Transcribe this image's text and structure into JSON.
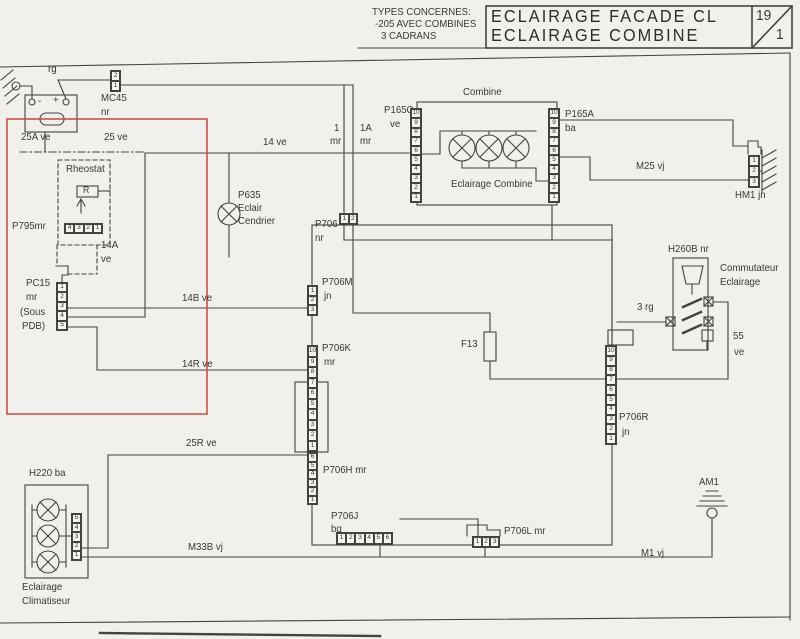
{
  "header": {
    "types_line1": "TYPES CONCERNES:",
    "types_line2": "-205 AVEC COMBINES",
    "types_line3": "3 CADRANS",
    "title_line1": "ECLAIRAGE FACADE CL",
    "title_line2": "ECLAIRAGE COMBINE",
    "page_num": "19",
    "page_den": "1"
  },
  "colors": {
    "red_zone": "#c2493f",
    "line": "#45433e"
  },
  "battery": {
    "minus": "-",
    "plus": "+"
  },
  "wire_labels": {
    "rg": "rg",
    "ve25a": "25A ve",
    "ve25": "25 ve",
    "ve14": "14 ve",
    "one": "1",
    "one_mr": "mr",
    "onea": "1A",
    "onea_mr": "mr",
    "ve14a_1": "14A",
    "ve14a_2": "ve",
    "ve14b": "14B ve",
    "ve14r": "14R ve",
    "ve25r": "25R ve",
    "m33b": "M33B vj",
    "m25": "M25 vj",
    "m1": "M1 vj",
    "rg3": "3 rg",
    "v55_1": "55",
    "v55_2": "ve",
    "f13": "F13",
    "am1": "AM1"
  },
  "components": {
    "rheostat": {
      "label": "Rheostat",
      "symbol": "R"
    },
    "p635": {
      "name": "P635",
      "line2": "Eclair",
      "line3": "Cendrier"
    },
    "combine": {
      "title": "Combine",
      "caption": "Eclairage Combine"
    },
    "h260b": {
      "name": "H260B nr",
      "desc1": "Commutateur",
      "desc2": "Eclairage"
    },
    "h220": {
      "name": "H220 ba",
      "desc1": "Eclairage",
      "desc2": "Climatiseur"
    }
  },
  "connectors": {
    "mc45": {
      "name": "MC45",
      "sub": "nr",
      "pins": [
        "2",
        "1"
      ]
    },
    "p795": {
      "name": "P795mr",
      "pins": [
        "4",
        "3",
        "2",
        "1"
      ]
    },
    "pc15": {
      "name": "PC15",
      "sub": "mr",
      "sub2": "(Sous",
      "sub3": "PDB)",
      "pins": [
        "1",
        "2",
        "3",
        "4",
        "5"
      ]
    },
    "p706": {
      "name": "P706",
      "sub": "nr",
      "pins": [
        "1",
        "2"
      ]
    },
    "p706m": {
      "name": "P706M",
      "sub": "jn",
      "pins": [
        "1",
        "2",
        "3"
      ]
    },
    "p706k": {
      "name": "P706K",
      "sub": "mr",
      "pins": [
        "10",
        "9",
        "8",
        "7",
        "6",
        "5",
        "4",
        "3",
        "2",
        "1"
      ]
    },
    "p706h": {
      "name": "P706H mr",
      "pins": [
        "6",
        "5",
        "4",
        "3",
        "2",
        "1"
      ]
    },
    "p706j": {
      "name": "P706J",
      "sub": "bq",
      "pins": [
        "1",
        "2",
        "3",
        "4",
        "5",
        "6"
      ]
    },
    "p706l": {
      "name": "P706L mr",
      "pins": [
        "1",
        "2",
        "3"
      ]
    },
    "p706r": {
      "name": "P706R",
      "sub": "jn",
      "pins": [
        "10",
        "9",
        "8",
        "7",
        "6",
        "5",
        "4",
        "3",
        "2",
        "1"
      ]
    },
    "p165c": {
      "name": "P165C",
      "sub": "ve",
      "pins": [
        "10",
        "9",
        "8",
        "7",
        "6",
        "5",
        "4",
        "3",
        "2",
        "1"
      ]
    },
    "p165a": {
      "name": "P165A",
      "sub": "ba",
      "pins": [
        "10",
        "9",
        "8",
        "7",
        "6",
        "5",
        "4",
        "3",
        "2",
        "1"
      ]
    },
    "hm1": {
      "name": "HM1 jn",
      "pins": [
        "1",
        "2",
        "3"
      ]
    },
    "h220c": {
      "pins": [
        "5",
        "4",
        "3",
        "2",
        "1"
      ]
    }
  }
}
